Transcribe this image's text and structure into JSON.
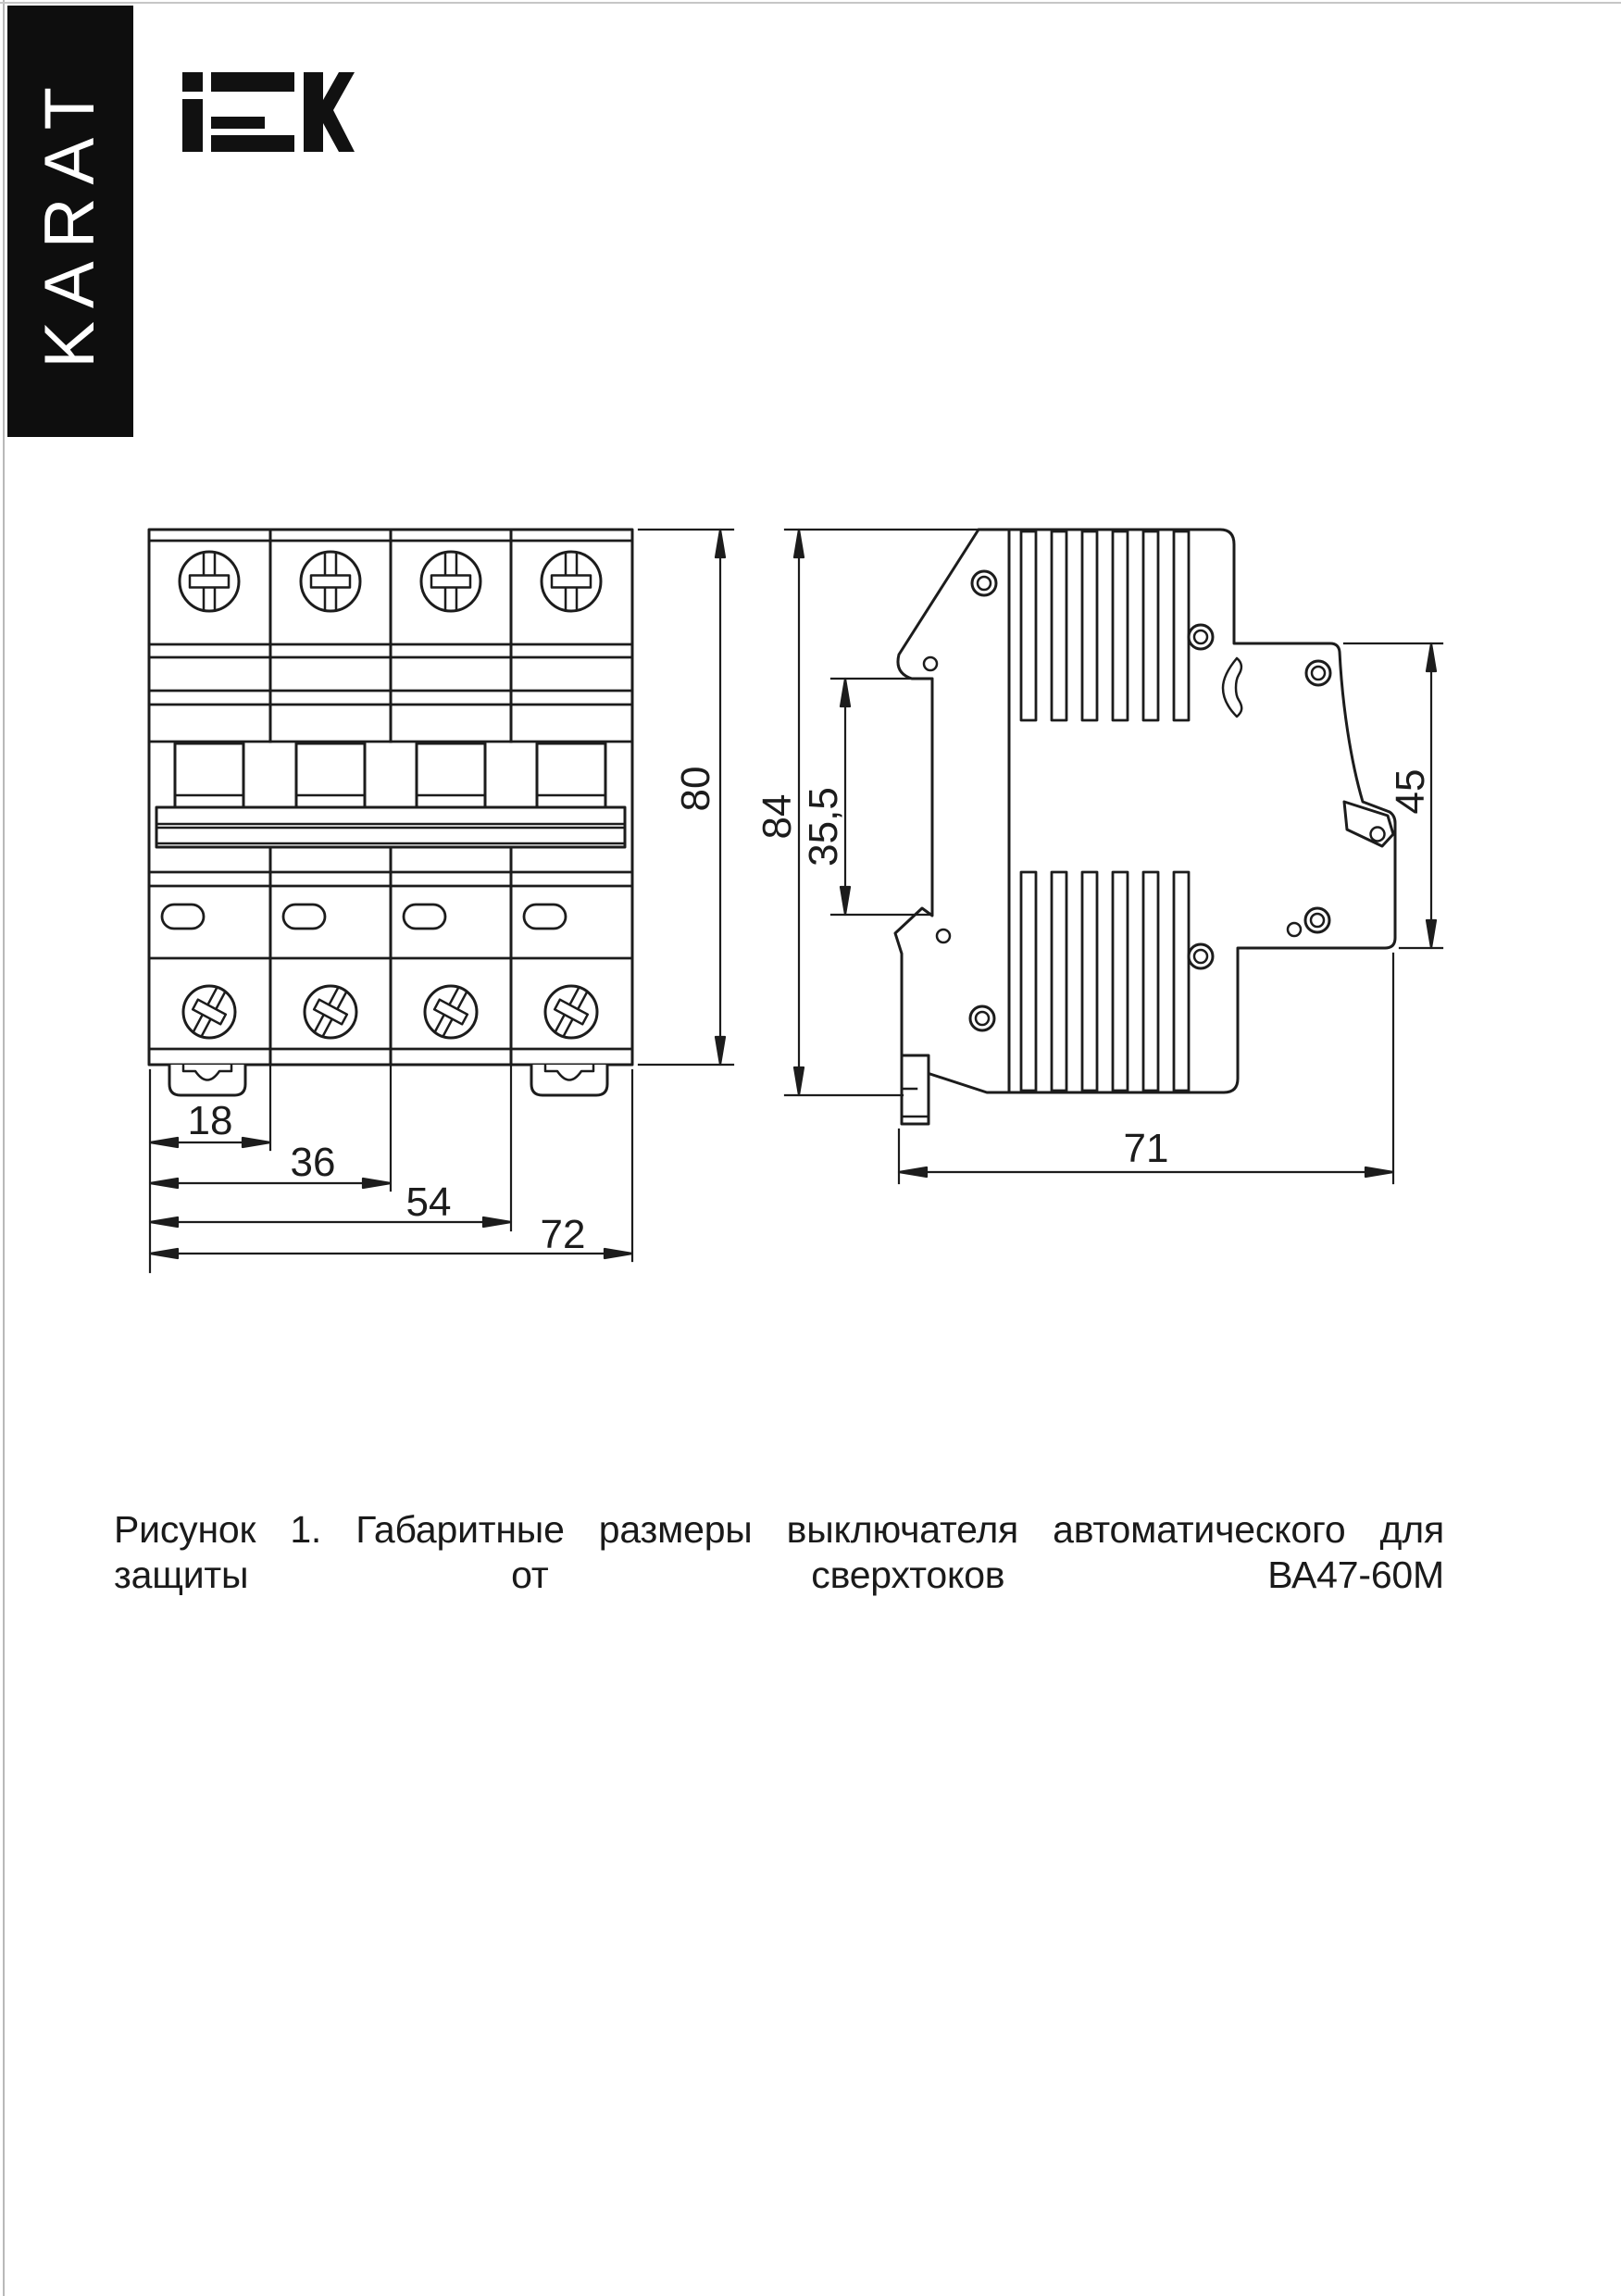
{
  "page": {
    "background": "#ffffff",
    "line_color": "#1c1c1c"
  },
  "brand": {
    "name": "KARAT",
    "logo": "IEK"
  },
  "figure": {
    "caption": "Рисунок 1. Габаритные размеры выключателя автоматического для защиты от сверхтоков ВА47-60М",
    "product": "ВА47-60М",
    "views": {
      "front": {
        "title": "front-view",
        "dims": {
          "height": "80",
          "module_width": "18",
          "two_modules": "36",
          "three_modules": "54",
          "total_width": "72"
        }
      },
      "side": {
        "title": "side-view",
        "dims": {
          "height": "84",
          "front_panel": "35,5",
          "terminal_depth": "45",
          "depth": "71"
        }
      }
    }
  }
}
